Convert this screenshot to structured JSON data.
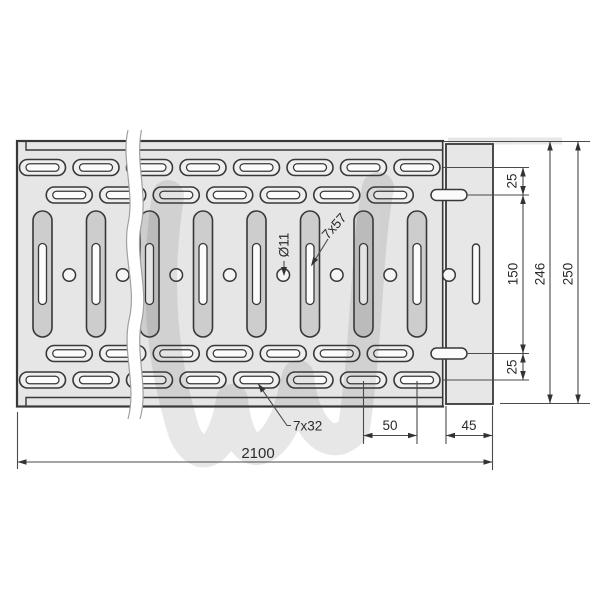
{
  "drawing": {
    "kind": "technical-drawing",
    "dimensions": {
      "overall_length": "2100",
      "overall_width": "250",
      "flange_width": "246",
      "row_offset_top": "25",
      "row_offset_bottom": "25",
      "row_spacing": "150",
      "slot_pitch": "50",
      "flange_length": "45"
    },
    "callouts": {
      "round_hole": "Ø11",
      "vertical_slot": "7x57",
      "horizontal_slot": "7x32"
    },
    "pattern": {
      "capsule_columns": 8,
      "offset_columns": 7,
      "round_hole_count": 8
    },
    "palette": {
      "plate_fill": "#e6e6e6",
      "capsule_fill": "#cdcdcd",
      "slot_ring_fill": "#efefef",
      "slot_inner_fill": "#fcfcfc",
      "flange_fill": "#e7e7e7",
      "junction_fill": "#f3f3f3",
      "outline": "#383838",
      "dimension_line": "#4a4a4a",
      "watermark": "#c9c9c9",
      "background": "#ffffff"
    }
  }
}
